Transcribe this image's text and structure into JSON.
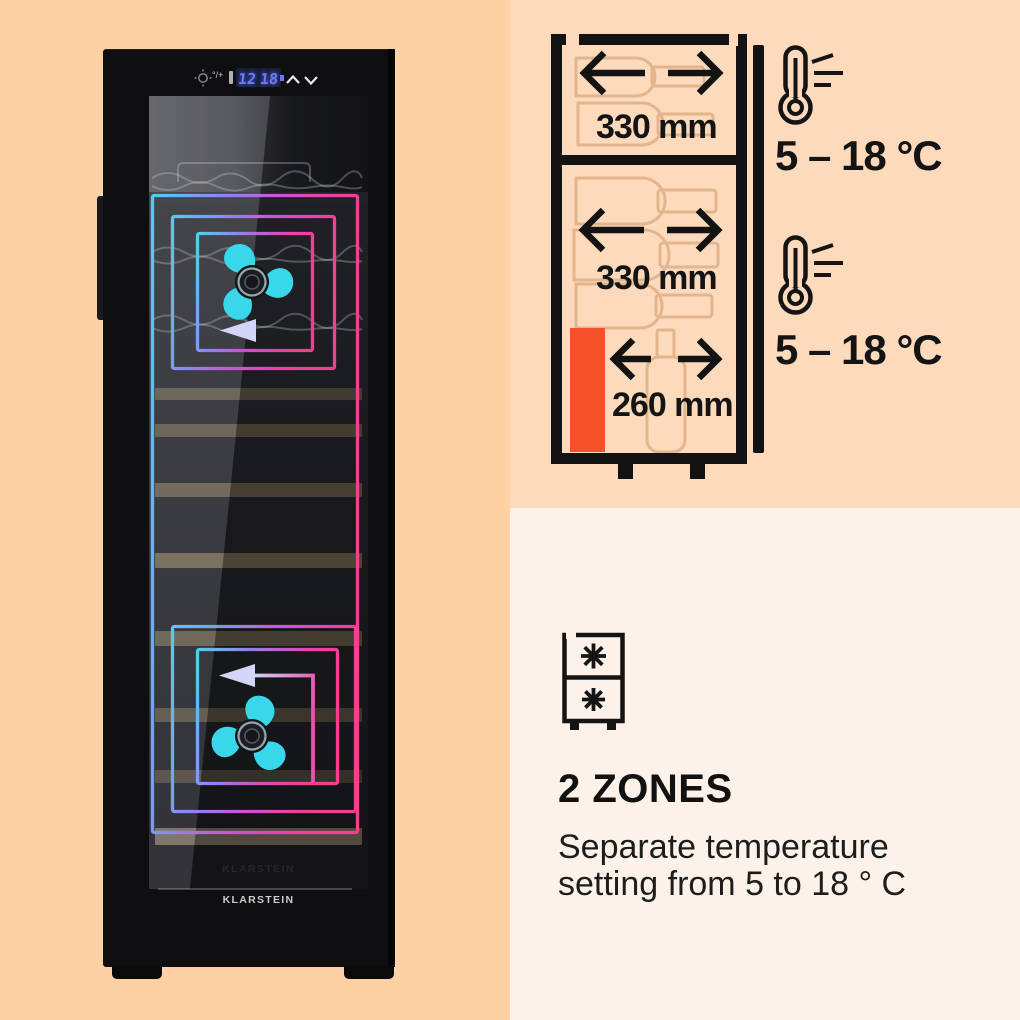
{
  "fridge": {
    "brand": "KLARSTEIN",
    "display": {
      "zone1_temp": "12",
      "zone2_temp": "18",
      "mode_label": "°/+"
    }
  },
  "diagram": {
    "widths": [
      "330 mm",
      "330 mm",
      "260 mm"
    ],
    "zone_temps": [
      "5 – 18 °C",
      "5 – 18 °C"
    ]
  },
  "info": {
    "heading": "2 ZONES",
    "line1": "Separate temperature",
    "line2": "setting from 5 to 18 ° C"
  },
  "colors": {
    "bg_left": "#fdd1a3",
    "bg_top_right": "#fcdabb",
    "bg_bottom_right": "#fcf2e9",
    "accent_orange": "#f4512b",
    "fan_cyan": "#39d7ea",
    "display_blue": "#6d79f5"
  }
}
